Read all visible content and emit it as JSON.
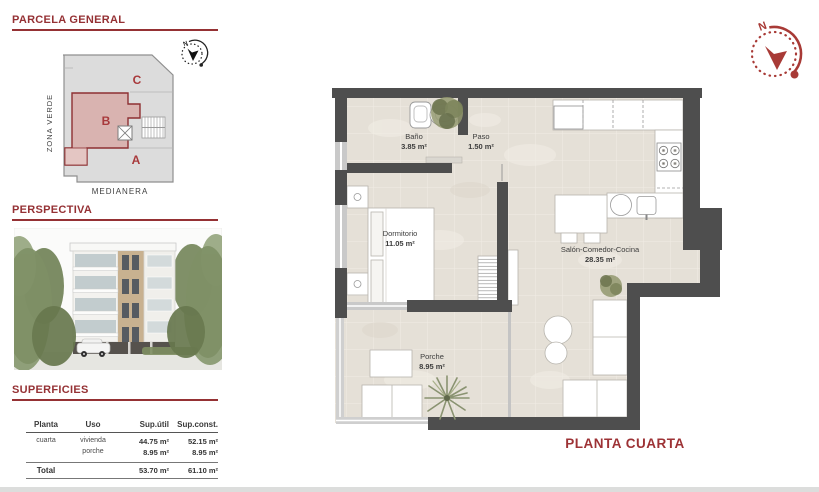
{
  "colors": {
    "accent_red": "#953134",
    "zone_letter_red": "#a8393b",
    "wall_gray": "#4e4e4e",
    "floor_beige": "#e5e0d7",
    "zone_b_pink": "#d9b3b0",
    "site_gray": "#dcdcdc",
    "plant_green": "#8a9371"
  },
  "sidebar": {
    "parcela": {
      "title": "PARCELA GENERAL",
      "zone_a": "A",
      "zone_b": "B",
      "zone_c": "C",
      "left_label": "ZONA VERDE",
      "bottom_label": "MEDIANERA",
      "compass_n": "N"
    },
    "perspectiva": {
      "title": "PERSPECTIVA"
    },
    "superficies": {
      "title": "SUPERFICIES",
      "headers": [
        "Planta",
        "Uso",
        "Sup.útil",
        "Sup.const."
      ],
      "rows": [
        {
          "planta": "cuarta",
          "uso": "vivienda",
          "util": "44.75 m²",
          "sconst": "52.15 m²"
        },
        {
          "planta": "",
          "uso": "porche",
          "util": "8.95 m²",
          "sconst": "8.95 m²"
        }
      ],
      "total": {
        "label": "Total",
        "util": "53.70 m²",
        "sconst": "61.10 m²"
      }
    }
  },
  "plan": {
    "caption": "PLANTA CUARTA",
    "compass_n": "N",
    "rooms": [
      {
        "name": "Baño",
        "area": "3.85 m²"
      },
      {
        "name": "Paso",
        "area": "1.50 m²"
      },
      {
        "name": "Dormitorio",
        "area": "11.05 m²"
      },
      {
        "name": "Salón-Comedor-Cocina",
        "area": "28.35 m²"
      },
      {
        "name": "Porche",
        "area": "8.95 m²"
      }
    ]
  }
}
